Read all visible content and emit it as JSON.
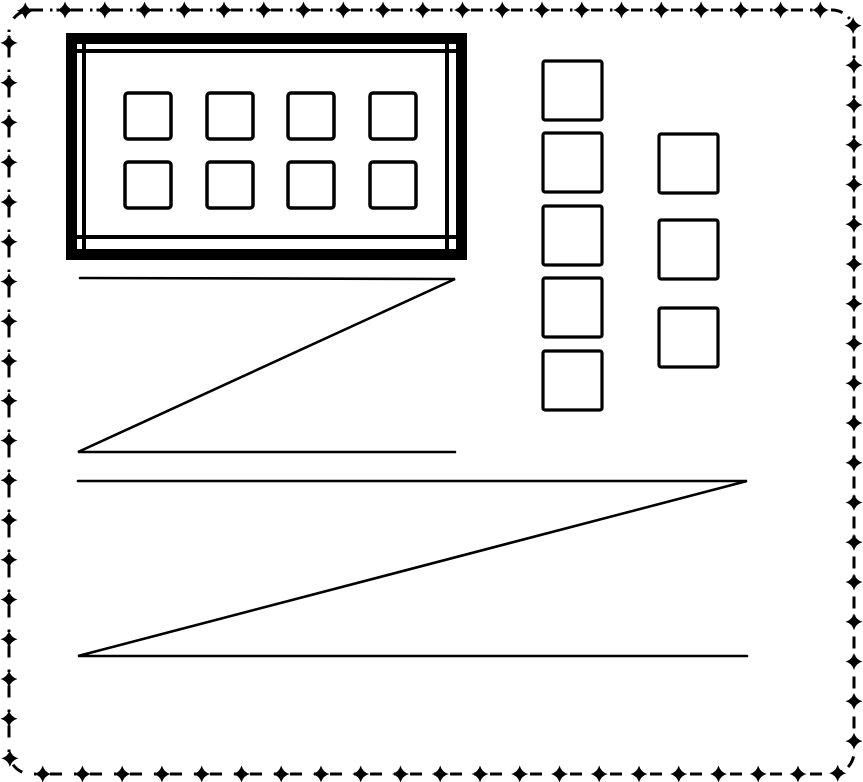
{
  "figure": {
    "canvas": {
      "width": 863,
      "height": 782,
      "background_color": "#ffffff",
      "ink_color": "#000000"
    },
    "decorative_border": {
      "x": 9,
      "y": 10,
      "width": 845,
      "height": 764,
      "corner_radius": 22,
      "stroke_width": 3,
      "dash_pattern": "12 7 2.5 4 2.5 12",
      "star_spacing": 40,
      "star_phase": 34,
      "star_outer_radius": 8.5,
      "star_inner_radius": 1.8
    },
    "panel": {
      "outer_frame": {
        "x": 66,
        "y": 33,
        "width": 401,
        "height": 227,
        "stroke_width": 11
      },
      "inner_frame": {
        "stroke_width": 4,
        "h_lines": [
          {
            "y": 51,
            "x1": 72,
            "x2": 461
          },
          {
            "y": 237,
            "x1": 72,
            "x2": 461
          }
        ],
        "v_lines": [
          {
            "x": 84,
            "y1": 40,
            "y2": 253
          },
          {
            "x": 447,
            "y1": 40,
            "y2": 253
          }
        ]
      },
      "cells": {
        "x_positions": [
          125,
          207,
          288,
          370
        ],
        "y_positions": [
          93,
          162
        ],
        "size": 46,
        "corner_radius": 3,
        "stroke_width": 3.5
      }
    },
    "square_columns": [
      {
        "name": "column-a-square",
        "x": 543,
        "size": 59,
        "corner_radius": 2,
        "stroke_width": 3.2,
        "y_positions": [
          61,
          133,
          206,
          278,
          351
        ]
      },
      {
        "name": "column-b-square",
        "x": 659,
        "size": 59,
        "corner_radius": 2,
        "stroke_width": 3.2,
        "y_positions": [
          134,
          220,
          308
        ]
      }
    ],
    "zigzags": [
      {
        "name": "zigzag-small",
        "stroke_width": 2.6,
        "points": [
          [
            80,
            278
          ],
          [
            455,
            279
          ],
          [
            78,
            452
          ],
          [
            455,
            452
          ]
        ]
      },
      {
        "name": "zigzag-large",
        "stroke_width": 2.6,
        "points": [
          [
            78,
            481
          ],
          [
            747,
            481
          ],
          [
            78,
            656
          ],
          [
            747,
            656
          ]
        ]
      }
    ]
  }
}
